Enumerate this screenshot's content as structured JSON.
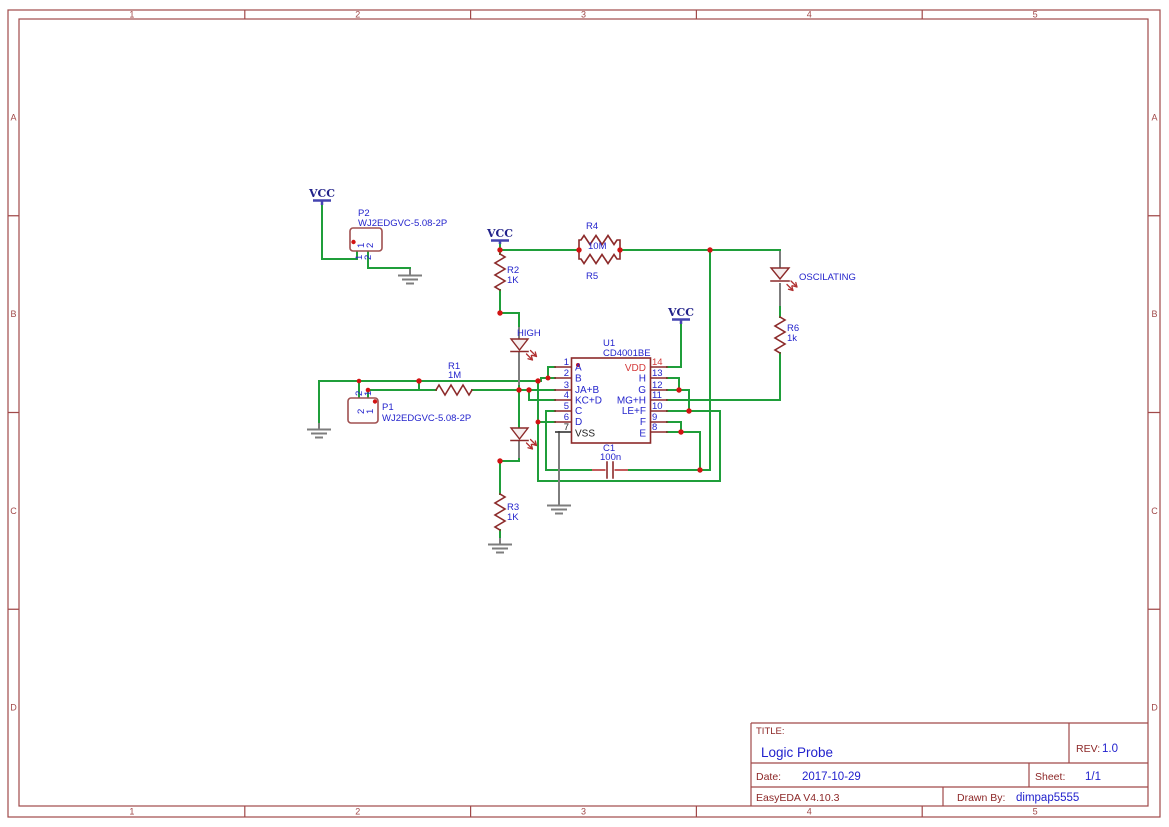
{
  "frame": {
    "columns": [
      "1",
      "2",
      "3",
      "4",
      "5"
    ],
    "rows": [
      "A",
      "B",
      "C",
      "D"
    ]
  },
  "title_block": {
    "title_label": "TITLE:",
    "title": "Logic Probe",
    "rev_label": "REV:",
    "rev": "1.0",
    "date_label": "Date:",
    "date": "2017-10-29",
    "sheet_label": "Sheet:",
    "sheet": "1/1",
    "software_version": "EasyEDA V4.10.3",
    "drawn_by_label": "Drawn By:",
    "drawn_by": "dimpap5555"
  },
  "net_labels": {
    "vcc": "VCC"
  },
  "components": {
    "p2": {
      "ref": "P2",
      "value": "WJ2EDGVC-5.08-2P",
      "pins": [
        "1",
        "2"
      ]
    },
    "p1": {
      "ref": "P1",
      "value": "WJ2EDGVC-5.08-2P",
      "pins": [
        "1",
        "2"
      ]
    },
    "r1": {
      "ref": "R1",
      "value": "1M"
    },
    "r2": {
      "ref": "R2",
      "value": "1K"
    },
    "r3": {
      "ref": "R3",
      "value": "1K"
    },
    "r4": {
      "ref": "R4"
    },
    "r5": {
      "ref": "R5"
    },
    "r45_value": "10M",
    "r6": {
      "ref": "R6",
      "value": "1k"
    },
    "c1": {
      "ref": "C1",
      "value": "100n"
    },
    "u1": {
      "ref": "U1",
      "value": "CD4001BE",
      "left_pins": [
        {
          "num": "1",
          "name": "A"
        },
        {
          "num": "2",
          "name": "B"
        },
        {
          "num": "3",
          "name": "JA+B"
        },
        {
          "num": "4",
          "name": "KC+D"
        },
        {
          "num": "5",
          "name": "C"
        },
        {
          "num": "6",
          "name": "D"
        },
        {
          "num": "7",
          "name": "VSS"
        }
      ],
      "right_pins": [
        {
          "num": "14",
          "name": "VDD"
        },
        {
          "num": "13",
          "name": "H"
        },
        {
          "num": "12",
          "name": "G"
        },
        {
          "num": "11",
          "name": "MG+H"
        },
        {
          "num": "10",
          "name": "LE+F"
        },
        {
          "num": "9",
          "name": "F"
        },
        {
          "num": "8",
          "name": "E"
        }
      ]
    },
    "led_high": {
      "label": "HIGH"
    },
    "led_oscillating": {
      "label": "OSCILATING"
    }
  }
}
